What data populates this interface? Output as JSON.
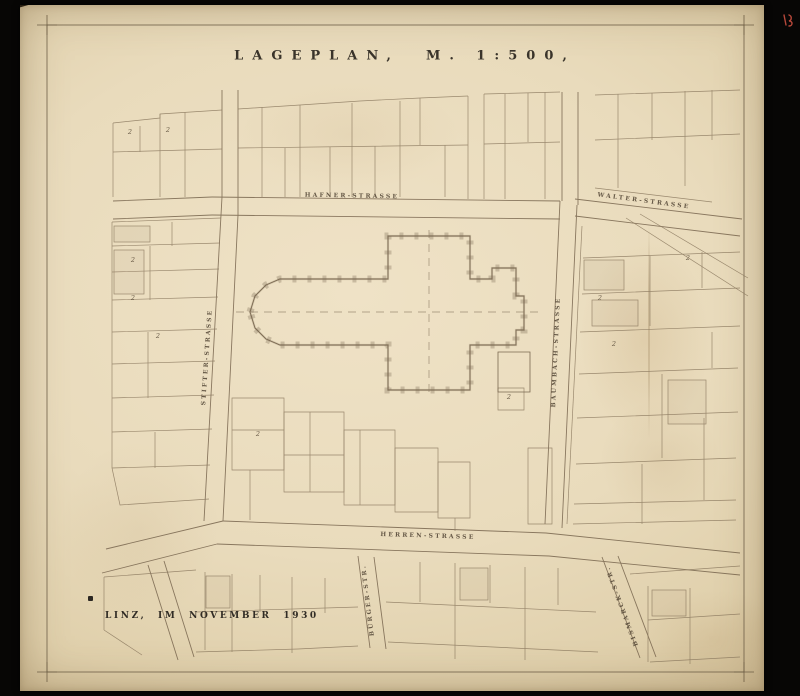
{
  "sheet": {
    "title": "LAGEPLAN,",
    "scale": "M. 1:500,",
    "inscription": "LINZ, IM NOVEMBER 1930"
  },
  "streets": {
    "top": "HAFNER-STRASSE",
    "top_right": "WALTER-STRASSE",
    "left": "STIFTER-STRASSE",
    "right": "BAUMBACH-STRASSE",
    "bottom": "HERREN-STRASSE",
    "bottom_left": "BÜRGER-STR.",
    "bottom_right": "BISMARCK-STR."
  },
  "parcel_marks": [
    "2",
    "2",
    "2",
    "2",
    "2",
    "2",
    "2",
    "2",
    "2",
    "2"
  ],
  "colors": {
    "background": "#070605",
    "paper": "#e9dbbc",
    "line_ink": "#8c7a60",
    "text_ink": "#4a4236",
    "red_mark": "#b5473a"
  }
}
